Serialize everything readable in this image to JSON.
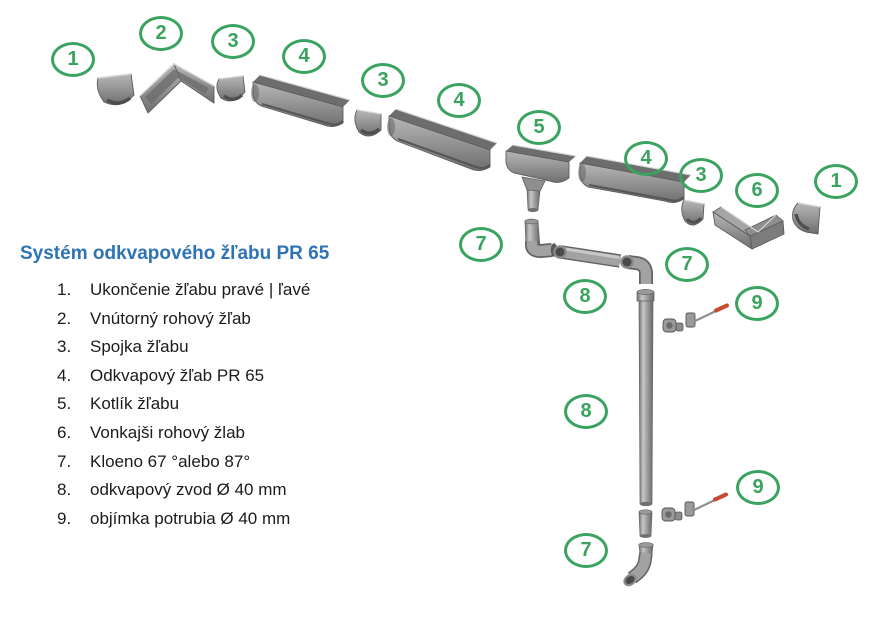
{
  "title": "Systém odkvapového žľabu PR 65",
  "colors": {
    "title_blue": "#2e74b5",
    "badge_green": "#3aa35f",
    "screw_red": "#c64a2e",
    "part_gray": "#8f8f8f"
  },
  "legend": {
    "items": [
      {
        "num": "1.",
        "label": "Ukončenie žľabu pravé | ľavé"
      },
      {
        "num": "2.",
        "label": "Vnútorný rohový žľab"
      },
      {
        "num": "3.",
        "label": "Spojka žľabu"
      },
      {
        "num": "4.",
        "label": "Odkvapový žľab PR 65"
      },
      {
        "num": "5.",
        "label": "Kotlík žľabu"
      },
      {
        "num": "6.",
        "label": "Vonkajši rohový žlab"
      },
      {
        "num": "7.",
        "label": "Kloeno 67 °alebo 87°"
      },
      {
        "num": "8.",
        "label": "odkvapový zvod Ø 40 mm"
      },
      {
        "num": "9.",
        "label": "objímka potrubia Ø 40 mm"
      }
    ]
  },
  "badges": [
    {
      "label": "1"
    },
    {
      "label": "2"
    },
    {
      "label": "3"
    },
    {
      "label": "4"
    },
    {
      "label": "3"
    },
    {
      "label": "4"
    },
    {
      "label": "5"
    },
    {
      "label": "4"
    },
    {
      "label": "3"
    },
    {
      "label": "6"
    },
    {
      "label": "1"
    },
    {
      "label": "7"
    },
    {
      "label": "7"
    },
    {
      "label": "8"
    },
    {
      "label": "9"
    },
    {
      "label": "8"
    },
    {
      "label": "9"
    },
    {
      "label": "7"
    }
  ]
}
